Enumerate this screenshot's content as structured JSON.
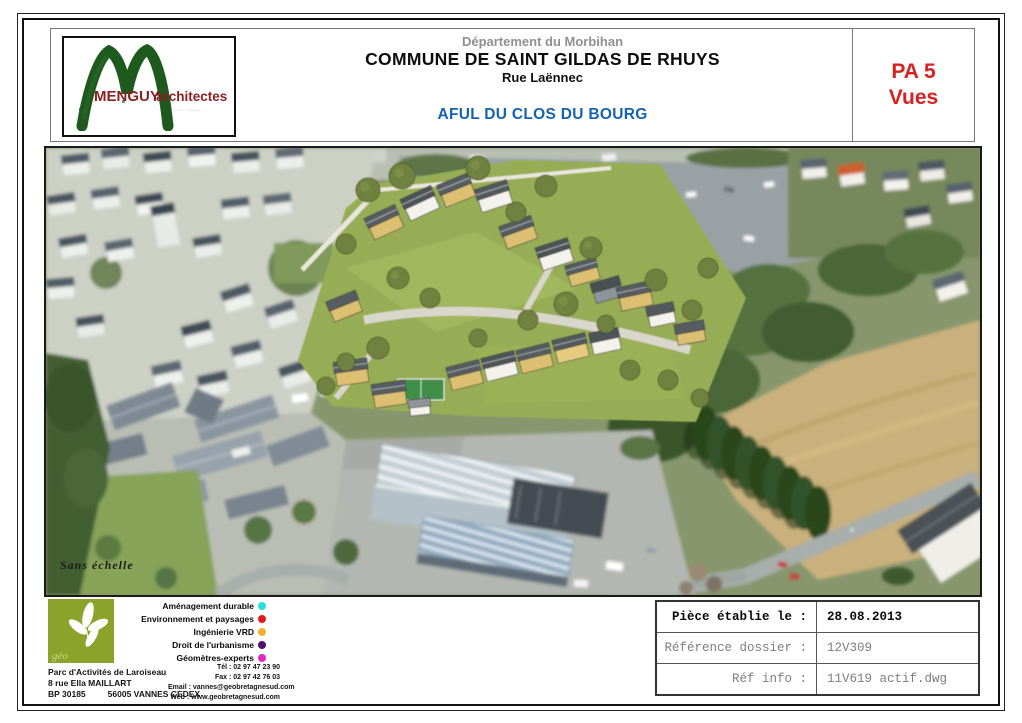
{
  "header": {
    "department": "Département du Morbihan",
    "commune": "COMMUNE DE SAINT GILDAS DE RHUYS",
    "street": "Rue Laënnec",
    "project": "AFUL DU CLOS DU BOURG",
    "pa_code": "PA 5",
    "pa_label": "Vues"
  },
  "architect": {
    "name": "MENGUY",
    "word": "architectes",
    "tagline": "··· ··· ·······"
  },
  "photo": {
    "scale_note": "Sans échelle"
  },
  "legend": {
    "items": [
      {
        "label": "Aménagement durable",
        "color": "#2bdede"
      },
      {
        "label": "Environnement et paysages",
        "color": "#e01b1b"
      },
      {
        "label": "Ingénierie VRD",
        "color": "#ecb22a"
      },
      {
        "label": "Droit de l'urbanisme",
        "color": "#4b1177"
      },
      {
        "label": "Géomètres-experts",
        "color": "#df2bc4"
      }
    ]
  },
  "surveyor": {
    "logo_text": "géo",
    "address": {
      "line1": "Parc d'Activités de Laroiseau",
      "line2": "8 rue Ella MAILLART",
      "bp": "BP 30185",
      "city": "56005 VANNES CEDEX"
    },
    "contact": {
      "lines": [
        "Tél : 02 97 47 23 90",
        "Fax : 02 97 42 76 03",
        "Email : vannes@geobretagnesud.com",
        "Web :  www.geobretagnesud.com"
      ]
    }
  },
  "info_table": {
    "rows": [
      {
        "label": "Pièce établie le :",
        "value": "28.08.2013"
      },
      {
        "label": "Référence dossier :",
        "value": "12V309"
      },
      {
        "label": "Réf info :",
        "value": "11V619 actif.dwg"
      }
    ]
  },
  "colors": {
    "accent_red": "#d92121",
    "title_blue": "#1563ae",
    "menguy_red": "#8c1f1f",
    "menguy_green": "#1e5a1e",
    "geo_olive": "#8ba32b"
  }
}
